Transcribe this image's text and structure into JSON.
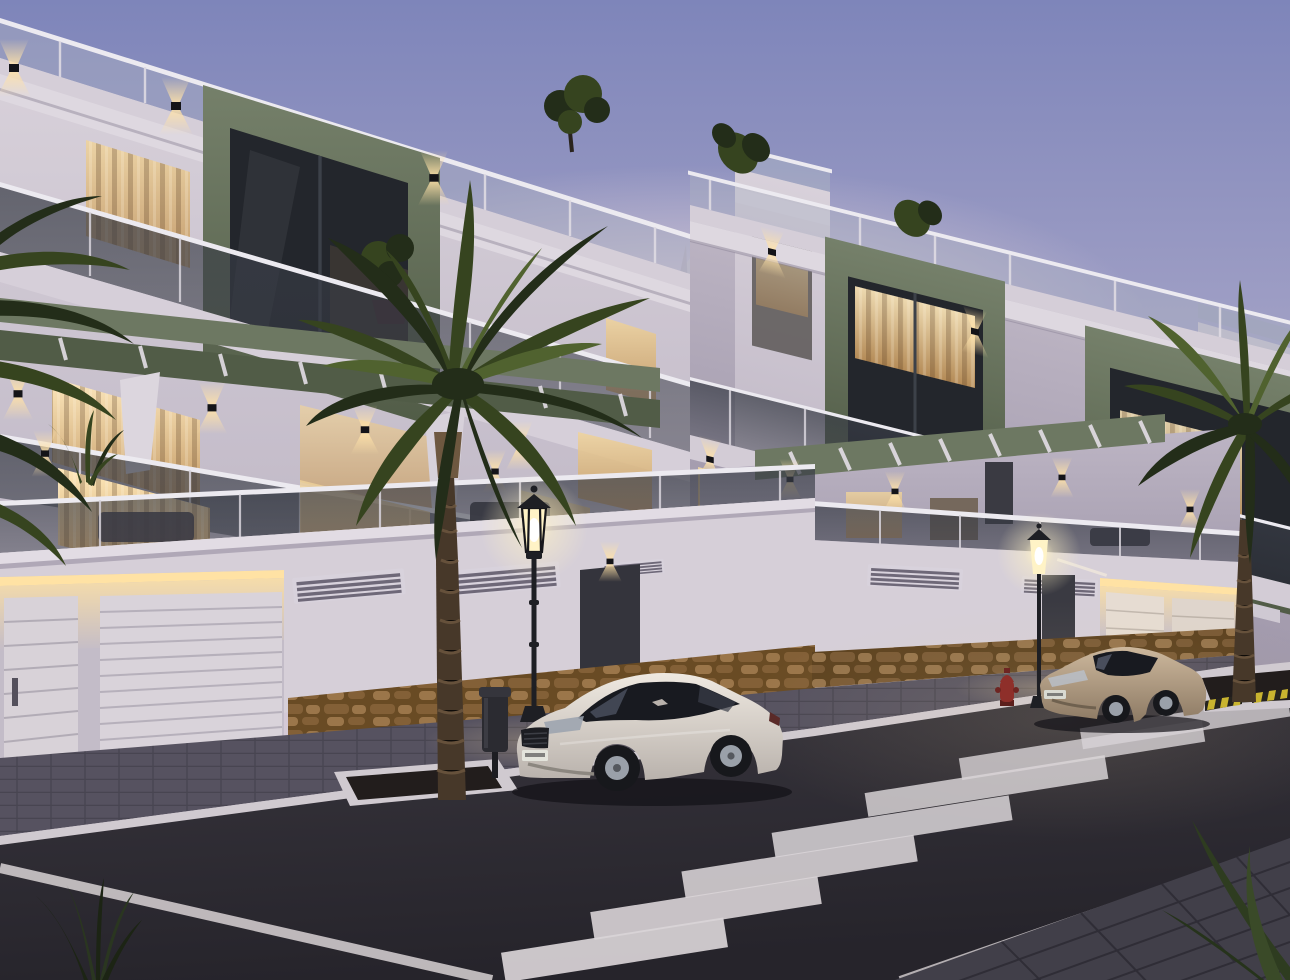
{
  "scene": {
    "kind": "architectural-dusk-render",
    "description_tags": [
      "apartment-buildings",
      "street",
      "palm-trees",
      "parked-cars",
      "crosswalk"
    ],
    "buildings": [
      {
        "name": "left-apartment-building",
        "floors": 3,
        "accent_boxes": 1,
        "garage_doors": 2
      },
      {
        "name": "right-apartment-building",
        "floors": 3,
        "accent_boxes": 2,
        "garage_doors": 2
      },
      {
        "name": "background-building",
        "floors": 1,
        "accent_boxes": 0,
        "garage_doors": 0
      }
    ],
    "vehicles": [
      {
        "name": "white-coupe",
        "body_color_key": "car_white_hi"
      },
      {
        "name": "beige-coupe",
        "body_color_key": "car_beige_hi"
      }
    ],
    "street_furniture": {
      "street_lamps": 2,
      "palm_trees": 2,
      "trash_bins": 1,
      "fire_hydrants": 1,
      "crosswalk_stripes": 7,
      "tree_pits": 2
    }
  },
  "colors": {
    "sky_top": "#7e85ba",
    "sky_mid": "#a6a4c7",
    "sky_low": "#cfc5d4",
    "sky_horizon": "#ddd0da",
    "glow_warm": "#e9d9dc",
    "facade_light": "#d8d1da",
    "facade_mid": "#bdb5c4",
    "facade_dark": "#9d95a8",
    "facade_deep": "#8a8295",
    "cornice": "#ded8e0",
    "green_light": "#75806a",
    "green_mid": "#65705a",
    "green_dark": "#515c47",
    "green_band": "#6d7862",
    "glass_dark": "#23262c",
    "glass_tint": "#383c46",
    "window_bright": "#ffe9bb",
    "window_warm": "#f0d49c",
    "window_deep": "#c2955c",
    "window_dim": "#6f6152",
    "podium": "#d6cfd8",
    "stone_light": "#96744b",
    "stone_mid": "#7a5a35",
    "stone_dark": "#5d421f",
    "sidewalk": "#565260",
    "curb": "#d0cad0",
    "road": "#3a373f",
    "road_dark": "#26242b",
    "stripe_white": "#d9d4d7",
    "caution_yellow": "#c9b42f",
    "caution_black": "#26241f",
    "palm_dark": "#232d19",
    "palm_mid": "#36441f",
    "palm_light": "#50622f",
    "trunk_dark": "#473829",
    "trunk_light": "#6e5840",
    "soil": "#221d1c",
    "lamp_glow": "#fff3c6",
    "lamp_metal": "#1e1f24",
    "led_warm": "#ffe2a4",
    "car_white_hi": "#efe9e1",
    "car_white_lo": "#b9b2ac",
    "car_glass": "#181a20",
    "car_beige_hi": "#cdb89d",
    "car_beige_lo": "#8d7a64",
    "bin": "#2b2b31",
    "hydrant": "#8e2f2a",
    "wheel_dark": "#17181c",
    "rim": "#9aa0a9"
  }
}
